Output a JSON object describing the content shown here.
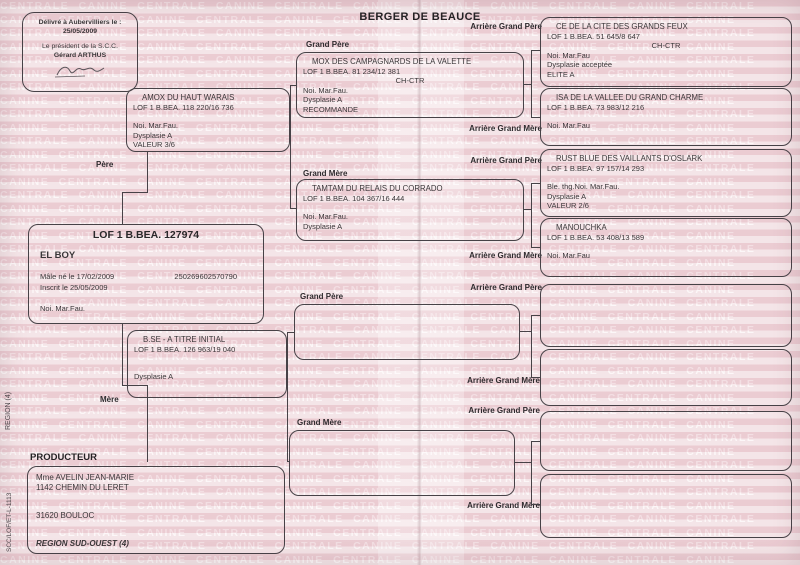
{
  "document": {
    "breed_title": "BERGER DE BEAUCE",
    "watermark_text": "CENTRALE CANINE",
    "stamp": {
      "issued": "Délivré à Aubervilliers le :",
      "issued_date": "25/05/2009",
      "president_title": "Le président de la S.C.C.",
      "president_name": "Gérard ARTHUS"
    },
    "labels": {
      "pere": "Père",
      "mere": "Mère",
      "grand_pere": "Grand Père",
      "grand_mere": "Grand Mère",
      "arriere_grand_pere": "Arrière Grand Père",
      "arriere_grand_mere": "Arrière Grand Mère",
      "producteur": "PRODUCTEUR"
    },
    "subject": {
      "lof": "LOF 1 B.BEA. 127974",
      "name": "EL BOY",
      "sex_birth": "Mâle   né le  17/02/2009",
      "chip": "250269602570790",
      "registered": "Inscrit le 25/05/2009",
      "color": "Noi. Mar.Fau."
    },
    "pere": {
      "name": "AMOX  DU HAUT WARAIS",
      "lof": "LOF 1 B.BEA. 118 220/16 736",
      "color": "Noi. Mar.Fau.",
      "dysplasie": "Dysplasie A",
      "valeur": "VALEUR 3/6"
    },
    "mere": {
      "name": "B.SE  - A TITRE INITIAL",
      "lof": "LOF 1 B.BEA. 126 963/19 040",
      "dysplasie": "Dysplasie A"
    },
    "grand_pere_paternel": {
      "name": "MOX  DES CAMPAGNARDS DE LA VALETTE",
      "lof": "LOF 1 B.BEA. 81 234/12 381",
      "titre": "CH-CTR",
      "color": "Noi. Mar.Fau.",
      "dysplasie": "Dysplasie A",
      "mention": "RECOMMANDE"
    },
    "grand_mere_paternelle": {
      "name": "TAMTAM  DU RELAIS DU CORRADO",
      "lof": "LOF 1 B.BEA. 104 367/16 444",
      "color": "Noi. Mar.Fau.",
      "dysplasie": "Dysplasie A"
    },
    "arriere_grand_pere_1": {
      "name": "CE DE LA CITE DES GRANDS FEUX",
      "lof": "LOF 1 B.BEA. 51 645/8 647",
      "titre": "CH-CTR",
      "color": "Noi. Mar.Fau",
      "dysplasie": "Dysplasie acceptée",
      "mention": "ELITE A"
    },
    "arriere_grand_mere_1": {
      "name": "ISA  DE LA VALLEE DU GRAND CHARME",
      "lof": "LOF 1 B.BEA. 73 983/12 216",
      "color": "Noi. Mar.Fau"
    },
    "arriere_grand_pere_2": {
      "name": "RUST BLUE  DES VAILLANTS D'OSLARK",
      "lof": "LOF 1 B.BEA. 97 157/14 293",
      "color": "Ble. thg.Noi. Mar.Fau.",
      "dysplasie": "Dysplasie A",
      "valeur": "VALEUR 2/6"
    },
    "arriere_grand_mere_2": {
      "name": "MANOUCHKA",
      "lof": "LOF 1 B.BEA. 53 408/13 589",
      "color": "Noi. Mar.Fau"
    },
    "producteur": {
      "name": "Mme AVELIN JEAN-MARIE",
      "address": "1142 CHEMIN DU LERET",
      "city": "31620 BOULOC",
      "region": "REGION SUD-OUEST (4)"
    },
    "side": {
      "region": "REGION (4)",
      "form_ref": "SCC/LOF/ET-L-1113"
    }
  }
}
